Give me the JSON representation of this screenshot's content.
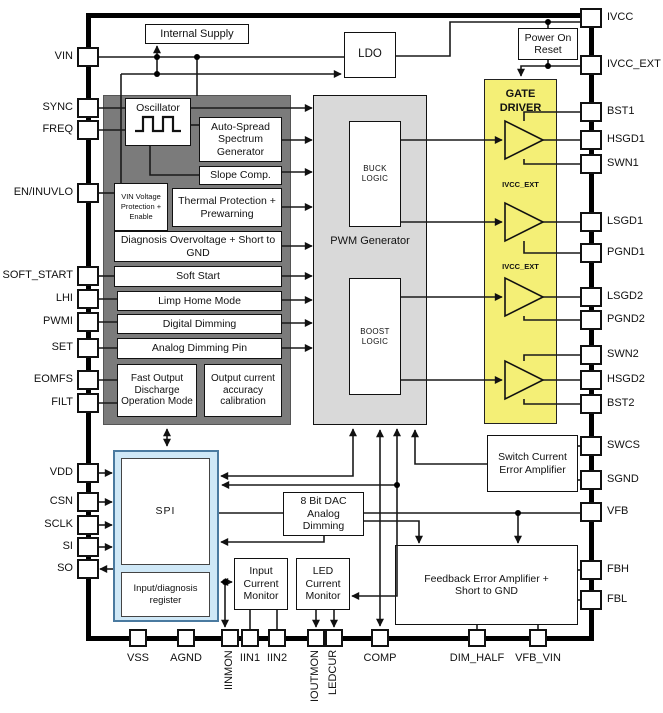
{
  "pins": {
    "left": [
      {
        "label": "VIN"
      },
      {
        "label": "SYNC"
      },
      {
        "label": "FREQ"
      },
      {
        "label": "EN/INUVLO"
      },
      {
        "label": "SOFT_START"
      },
      {
        "label": "LHI"
      },
      {
        "label": "PWMI"
      },
      {
        "label": "SET"
      },
      {
        "label": "EOMFS"
      },
      {
        "label": "FILT"
      },
      {
        "label": "VDD"
      },
      {
        "label": "CSN"
      },
      {
        "label": "SCLK"
      },
      {
        "label": "SI"
      },
      {
        "label": "SO"
      }
    ],
    "right": [
      {
        "label": "IVCC"
      },
      {
        "label": "IVCC_EXT"
      },
      {
        "label": "BST1"
      },
      {
        "label": "HSGD1"
      },
      {
        "label": "SWN1"
      },
      {
        "label": "LSGD1"
      },
      {
        "label": "PGND1"
      },
      {
        "label": "LSGD2"
      },
      {
        "label": "PGND2"
      },
      {
        "label": "SWN2"
      },
      {
        "label": "HSGD2"
      },
      {
        "label": "BST2"
      },
      {
        "label": "SWCS"
      },
      {
        "label": "SGND"
      },
      {
        "label": "VFB"
      },
      {
        "label": "FBH"
      },
      {
        "label": "FBL"
      }
    ],
    "bottom": [
      {
        "label": "VSS"
      },
      {
        "label": "AGND"
      },
      {
        "label": "IINMON"
      },
      {
        "label": "IIN1"
      },
      {
        "label": "IIN2"
      },
      {
        "label": "IOUTMON"
      },
      {
        "label": "LEDCUR"
      },
      {
        "label": "COMP"
      },
      {
        "label": "DIM_HALF"
      },
      {
        "label": "VFB_VIN"
      }
    ]
  },
  "blocks": {
    "internal_supply": "Internal Supply",
    "ldo": "LDO",
    "power_on_reset": "Power On Reset",
    "oscillator": "Oscillator",
    "auto_spread": "Auto-Spread Spectrum Generator",
    "slope_comp": "Slope Comp.",
    "vin_protection": "VIN Voltage Protection + Enable",
    "thermal": "Thermal Protection + Prewarning",
    "diagnosis": "Diagnosis Overvoltage + Short to GND",
    "soft_start": "Soft Start",
    "limp_home": "Limp Home Mode",
    "digital_dimming": "Digital Dimming",
    "analog_dimming": "Analog Dimming Pin",
    "fast_output_discharge": "Fast Output Discharge Operation Mode",
    "output_current_cal": "Output current accuracy calibration",
    "pwm_generator": "PWM Generator",
    "buck_logic": "BUCK LOGIC",
    "boost_logic": "BOOST LOGIC",
    "gate_driver": "GATE DRIVER",
    "ivcc_ext_rail": "IVCC_EXT",
    "switch_current_ea": "Switch Current Error Amplifier",
    "feedback_ea": "Feedback Error Amplifier + Short to GND",
    "spi": "SPI",
    "io_register": "Input/diagnosis register",
    "dac": "8 Bit DAC Analog Dimming",
    "input_current_monitor": "Input Current Monitor",
    "led_current_monitor": "LED Current Monitor"
  },
  "colors": {
    "function_block_gray": "#7b7b7b",
    "pwm_fill": "#d9d9d9",
    "gate_driver_yellow": "#f4ef76",
    "spi_fill": "#cfe8f7",
    "spi_border": "#4a7aa0",
    "wire": "#1a1a1a"
  }
}
